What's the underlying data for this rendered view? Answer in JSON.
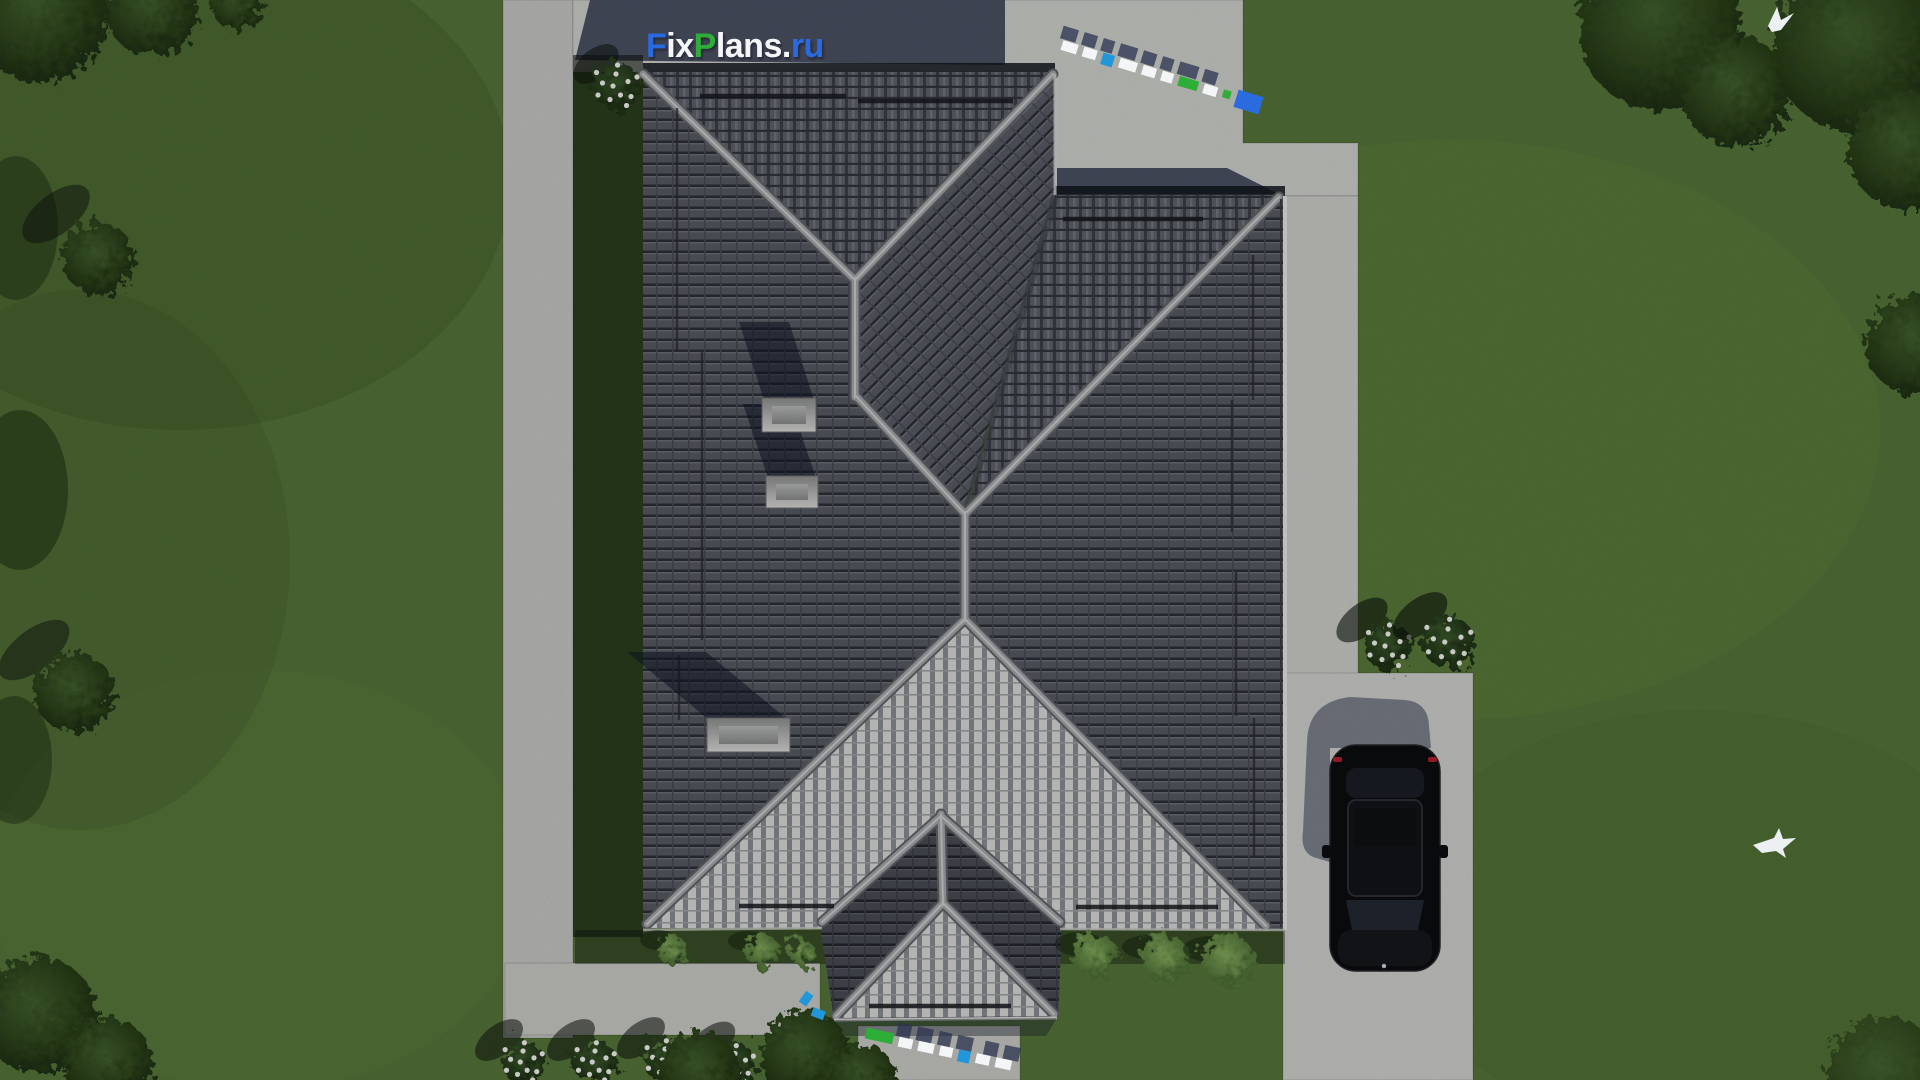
{
  "brand": {
    "full_text": "FixPlans.ru",
    "parts": [
      {
        "text": "F",
        "color": "#2b6be0"
      },
      {
        "text": "ix",
        "color": "#f4f5f7"
      },
      {
        "text": "P",
        "color": "#2fae37"
      },
      {
        "text": "lans.",
        "color": "#f4f5f7"
      },
      {
        "text": "ru",
        "color": "#2b6be0"
      }
    ]
  },
  "palette": {
    "grass": "#567539",
    "grass_light": "#6d8c4b",
    "grass_dark": "#31491f",
    "pavement": "#cbccc9",
    "shadow_navy": "#434a5e",
    "roof_base": "#565a62",
    "roof_bright": "#d9d9d6",
    "ridge": "#a4a6a9",
    "chimney": "#c6c7c6",
    "car_body": "#0c0d0f",
    "watermark_blue": "#2b6be0",
    "watermark_green": "#2fae37",
    "flower_white": "#f2f3ef"
  },
  "scene": {
    "view": "top-down aerial 3D render of house plot",
    "house": {
      "roof": "dark tiled hip roof with gabled entry porch",
      "chimneys": 3
    },
    "vehicle": {
      "type": "black car on driveway",
      "count": 1
    },
    "landscape": {
      "flower_bushes": 7,
      "birds": 2,
      "paths": "concrete walkways around lawn"
    }
  }
}
